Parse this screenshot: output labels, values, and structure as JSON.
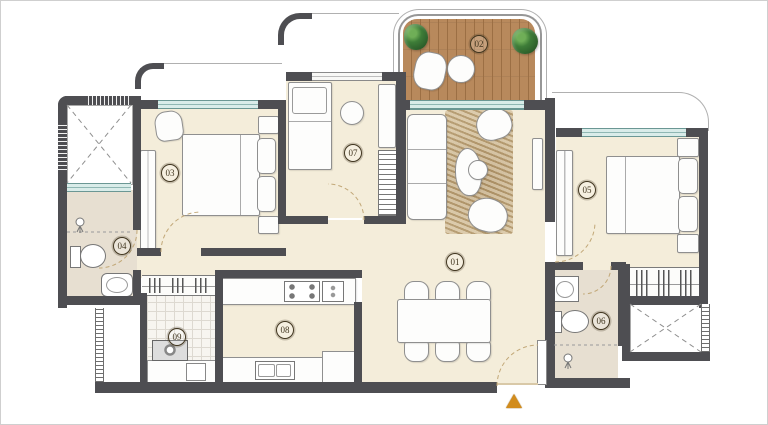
{
  "floor_plan": {
    "room_labels": {
      "living_dining": "01",
      "deck": "02",
      "bedroom_1": "03",
      "bath_1": "04",
      "bedroom_2": "05",
      "bath_2": "06",
      "bedroom_3": "07",
      "kitchen": "08",
      "utility": "09"
    },
    "colors": {
      "wall": "#4e4e52",
      "floor": "#f4edda",
      "bathroom_floor": "#e7dfd1",
      "deck_wood": "#b8895c",
      "window_glass": "#d9ece9",
      "rug": "#cdb68c",
      "plant_green": "#3e7d38",
      "entrance_arrow": "#d28c1c",
      "label_ink": "#40351f"
    }
  }
}
